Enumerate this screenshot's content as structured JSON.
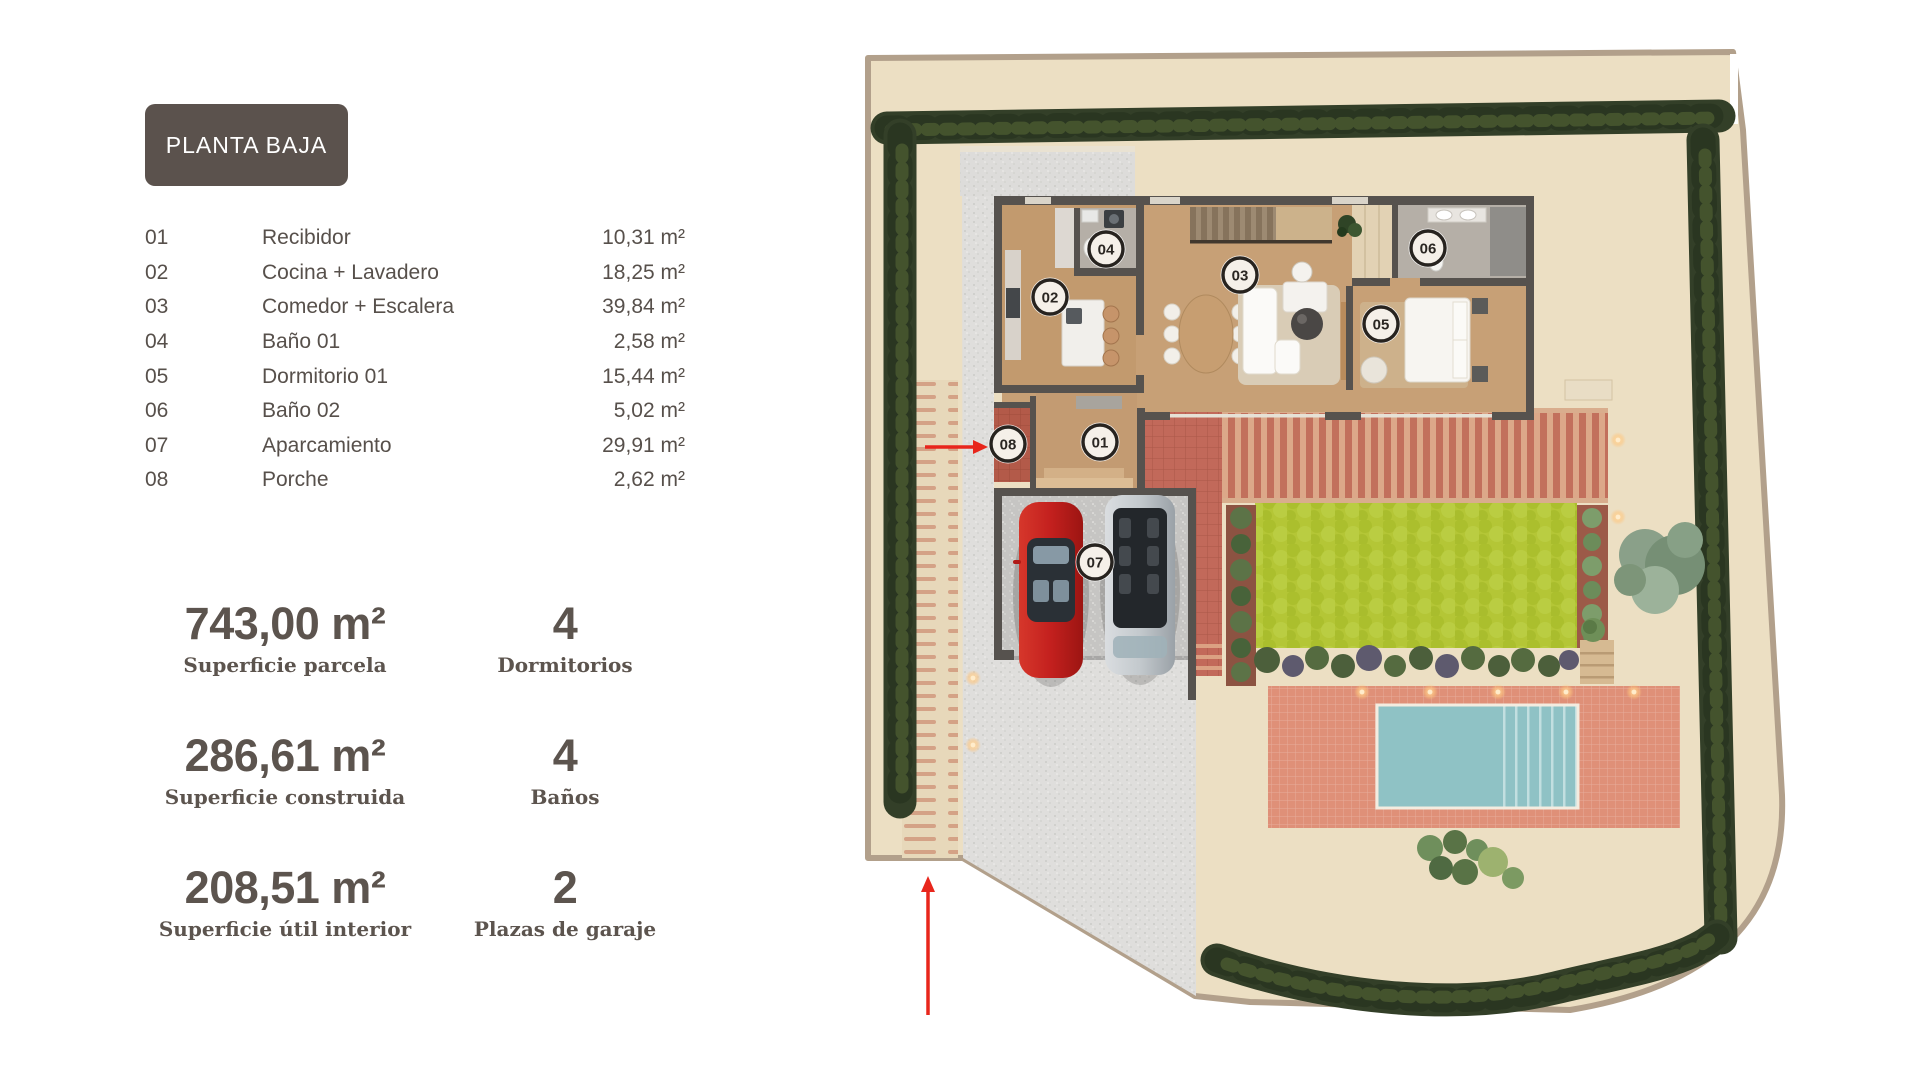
{
  "badge": {
    "label": "PLANTA BAJA"
  },
  "legend": {
    "rows": [
      {
        "num": "01",
        "name": "Recibidor",
        "area": "10,31 m²"
      },
      {
        "num": "02",
        "name": "Cocina + Lavadero",
        "area": "18,25 m²"
      },
      {
        "num": "03",
        "name": "Comedor + Escalera",
        "area": "39,84 m²"
      },
      {
        "num": "04",
        "name": "Baño 01",
        "area": "2,58 m²"
      },
      {
        "num": "05",
        "name": "Dormitorio 01",
        "area": "15,44 m²"
      },
      {
        "num": "06",
        "name": "Baño 02",
        "area": "5,02 m²"
      },
      {
        "num": "07",
        "name": "Aparcamiento",
        "area": "29,91 m²"
      },
      {
        "num": "08",
        "name": "Porche",
        "area": "2,62 m²"
      }
    ]
  },
  "stats": {
    "primary": [
      {
        "value": "743,00 m²",
        "label": "Superficie parcela"
      },
      {
        "value": "286,61 m²",
        "label": "Superficie construida"
      },
      {
        "value": "208,51 m²",
        "label": "Superficie útil interior"
      }
    ],
    "secondary": [
      {
        "value": "4",
        "label": "Dormitorios"
      },
      {
        "value": "4",
        "label": "Baños"
      },
      {
        "value": "2",
        "label": "Plazas de garaje"
      }
    ]
  },
  "plan": {
    "markers": [
      {
        "num": "01"
      },
      {
        "num": "02"
      },
      {
        "num": "03"
      },
      {
        "num": "04"
      },
      {
        "num": "05"
      },
      {
        "num": "06"
      },
      {
        "num": "07"
      },
      {
        "num": "08"
      }
    ],
    "colors": {
      "plot": "#ecdfc3",
      "boundary": "#b2a08b",
      "hedge": "#333f28",
      "wall": "#56524e",
      "wood_floor": "#c7a076",
      "kitchen_floor": "#c29a6e",
      "bath_floor": "#b5afa7",
      "hall_floor": "#c39b72",
      "lawn": "#b4c636",
      "pool": "#8fc2c5",
      "pool_terrace": "#df9078",
      "pergola": "#c2705c",
      "entrance_patio": "#c2695a",
      "porch": "#b35a49",
      "driveway": "#dfdedc",
      "garage_floor": "#c6c5c3",
      "parking_stripes": "#d09579",
      "accent_red": "#e8261c",
      "marker_bg": "#f5f0e9",
      "marker_ring": "#27231f",
      "text": "#57504b",
      "badge_bg": "#5b524d"
    }
  }
}
